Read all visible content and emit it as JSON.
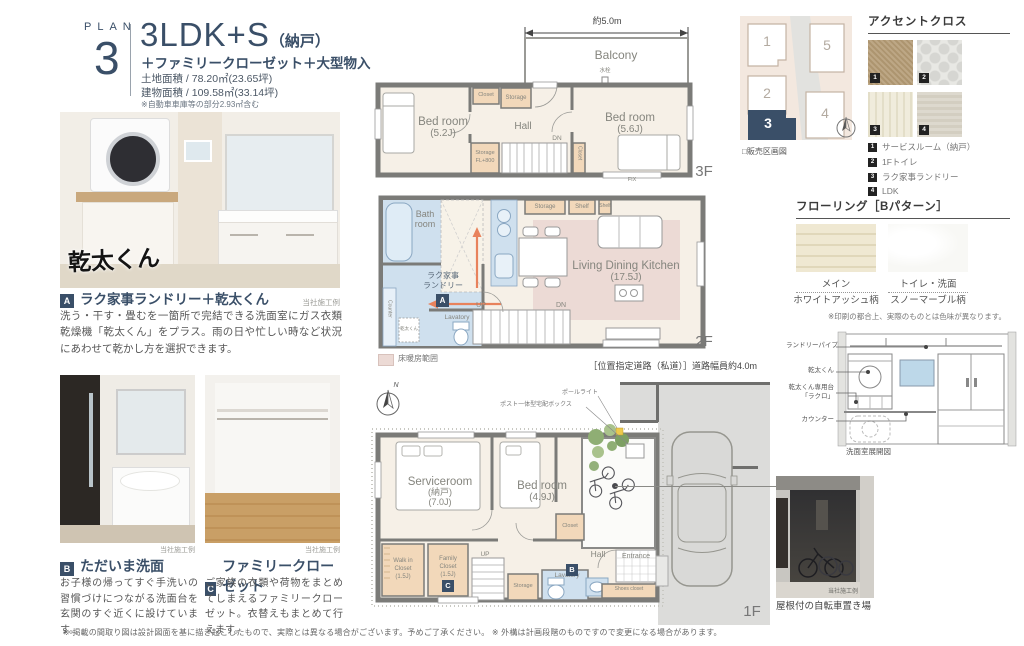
{
  "header": {
    "plan_word": "PLAN",
    "plan_number": "3",
    "title": "3LDK+S",
    "title_note": "（納戸）",
    "subtitle": "＋ファミリークローゼット＋大型物入",
    "land_area": "土地面積 / 78.20㎡(23.65坪)",
    "building_area": "建物面積 / 109.58㎡(33.14坪)",
    "area_note": "※自動車車庫等の部分2.93㎡含む"
  },
  "features": {
    "a": {
      "badge": "A",
      "title": "ラク家事ランドリー＋乾太くん",
      "credit": "当社施工例",
      "body": "洗う・干す・畳むを一箇所で完結できる洗面室にガス衣類乾燥機「乾太くん」をプラス。雨の日や忙しい時など状況にあわせて乾かし方を選択できます。",
      "photo_logo": "乾太くん"
    },
    "b": {
      "badge": "B",
      "title": "ただいま洗面",
      "credit": "当社施工例",
      "body": "お子様の帰ってすぐ手洗いの習慣づけにつながる洗面台を玄関のすぐ近くに設けています。"
    },
    "c": {
      "badge": "C",
      "title": "ファミリークローゼット",
      "credit": "当社施工例",
      "body": "ご家族の衣類や荷物をまとめてしまえるファミリークローゼット。衣替えもまとめて行えます。"
    }
  },
  "floor3": {
    "name": "3F",
    "dim": "約5.0m",
    "balcony": "Balcony",
    "faucet": "水栓",
    "bed1": "Bed room",
    "bed1_size": "(5.2J)",
    "hall": "Hall",
    "bed2": "Bed room",
    "bed2_size": "(5.6J)",
    "closet_top": "Closet",
    "storage_top": "Storage",
    "storage_b1": "Storage",
    "storage_b2": "FL+800",
    "closet_side": "Closet",
    "dn": "DN",
    "fix": "FIX"
  },
  "floor2": {
    "name": "2F",
    "bath1": "Bath",
    "bath2": "room",
    "laundry1": "ラク家事",
    "laundry2": "ランドリー",
    "badge_a": "A",
    "counter": "Counter",
    "kanta": "乾太くん",
    "lavatory": "Lavatory",
    "storage": "Storage",
    "shelf1": "Shelf",
    "shelf2": "Shelf",
    "ldk": "Living Dining Kitchen",
    "ldk_size": "(17.5J)",
    "up": "UP",
    "dn": "DN",
    "heating_legend": "床暖房範囲"
  },
  "floor1": {
    "name": "1F",
    "north": "N",
    "pole_light": "ポールライト",
    "delivery_box": "ポスト一体型宅配ボックス",
    "service1": "Serviceroom",
    "service2": "(納戸)",
    "service3": "(7.0J)",
    "bed": "Bed room",
    "bed_size": "(4.9J)",
    "closet": "Closet",
    "wic1": "Walk in",
    "wic2": "Closet",
    "wic3": "(1.5J)",
    "fam1": "Family",
    "fam2": "Closet",
    "fam3": "(1.5J)",
    "badge_c": "C",
    "up": "UP",
    "storage": "Storage",
    "lavatory": "Lavatory",
    "hall": "Hall",
    "badge_b": "B",
    "entrance": "Entrance",
    "shoes": "Shoes closet",
    "road_note": "［位置指定道路（私道）］道路幅員約4.0m"
  },
  "site_map": {
    "caption": "□販売区画図",
    "lot1": "1",
    "lot2": "2",
    "lot3": "3",
    "lot4": "4",
    "lot5": "5"
  },
  "accent_cloth": {
    "title": "アクセントクロス",
    "items": [
      {
        "num": "1",
        "label": "サービスルーム（納戸）"
      },
      {
        "num": "2",
        "label": "1Fトイレ"
      },
      {
        "num": "3",
        "label": "ラク家事ランドリー"
      },
      {
        "num": "4",
        "label": "LDK"
      }
    ]
  },
  "flooring": {
    "title": "フローリング［Bパターン］",
    "main_label": "メイン",
    "main_pattern": "ホワイトアッシュ柄",
    "toilet_label": "トイレ・洗面",
    "toilet_pattern": "スノーマーブル柄",
    "note": "※印刷の都合上、実際のものとは色味が異なります。"
  },
  "washroom": {
    "pipe": "ランドリーパイプ",
    "kanta": "乾太くん",
    "stand1": "乾太くん専用台",
    "stand2": "「ラクロ」",
    "counter": "カウンター",
    "caption": "洗面室展開図"
  },
  "bike": {
    "credit": "当社施工例",
    "caption": "屋根付の自転車置き場"
  },
  "footer": {
    "note": "※ 掲載の間取り図は設計図面を基に描き起こしたもので、実際とは異なる場合がございます。予めご了承ください。 ※ 外構は計画段階のものですので変更になる場合があります。"
  }
}
